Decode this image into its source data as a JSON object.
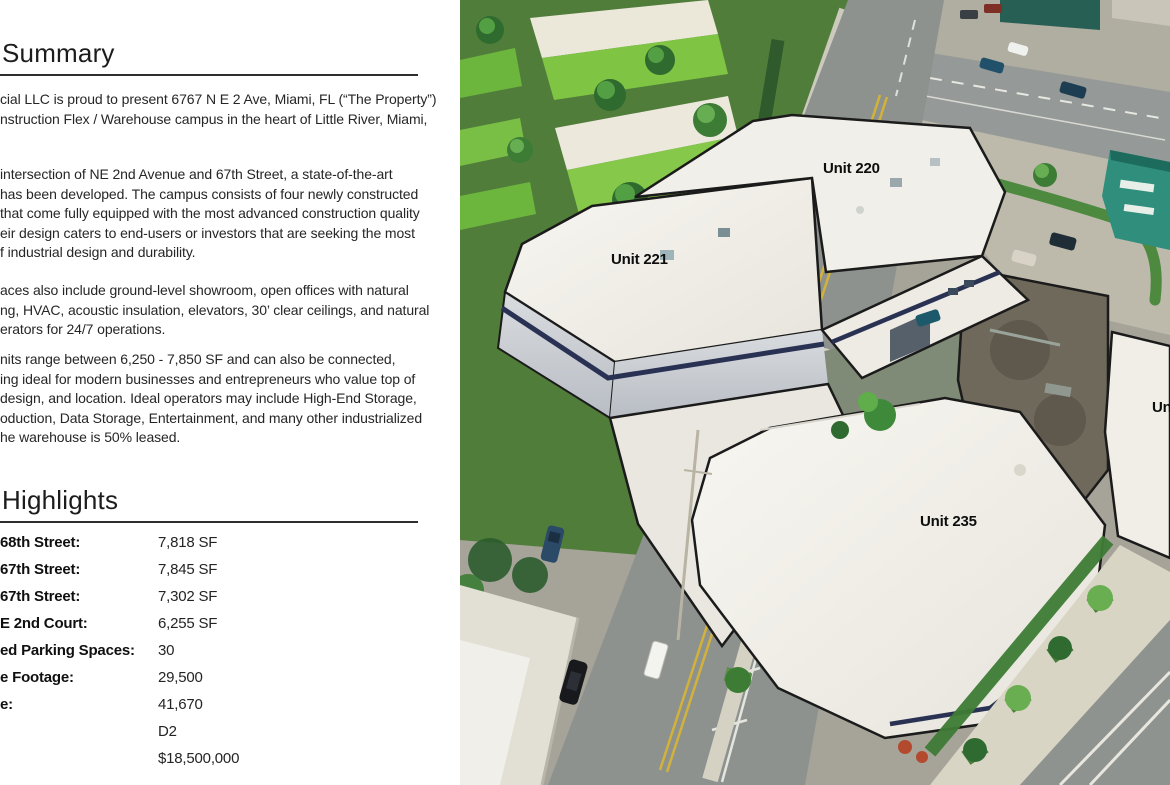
{
  "document": {
    "summary": {
      "title": "Summary",
      "paragraphs": [
        [
          "cial LLC is proud to present 6767 N E 2 Ave, Miami, FL (“The Property”)",
          "nstruction Flex / Warehouse campus in the heart of Little River, Miami,"
        ],
        [
          "intersection of NE 2nd Avenue and 67th Street, a state-of-the-art",
          "has been developed. The campus consists of four newly constructed",
          "that come fully equipped with the most advanced construction quality",
          "eir design caters to end-users or investors that are seeking the most",
          "f industrial design and durability."
        ],
        [
          "aces also include ground-level showroom, open offices with natural",
          "ng, HVAC, acoustic insulation, elevators, 30’ clear ceilings, and natural",
          "erators for 24/7 operations."
        ],
        [
          "nits range between 6,250 - 7,850 SF and can also be connected,",
          "ing ideal for modern businesses and entrepreneurs who value top of",
          "design, and location. Ideal operators may include High-End Storage,",
          "oduction, Data Storage, Entertainment, and many other industrialized",
          "he warehouse is 50% leased."
        ]
      ]
    },
    "highlights": {
      "title": "Highlights",
      "rows": [
        {
          "label": "68th Street:",
          "value": "7,818 SF"
        },
        {
          "label": "67th Street:",
          "value": "7,845 SF"
        },
        {
          "label": "67th Street:",
          "value": "7,302 SF"
        },
        {
          "label": "E 2nd Court:",
          "value": "6,255 SF"
        },
        {
          "label": "ed Parking Spaces:",
          "value": "30"
        },
        {
          "label": "e Footage:",
          "value": "29,500"
        },
        {
          "label": "e:",
          "value": "41,670"
        },
        {
          "label": "",
          "value": "D2"
        },
        {
          "label": "",
          "value": "$18,500,000"
        }
      ]
    }
  },
  "photo": {
    "description_labels": "aerial photo unit overlays",
    "unit_labels": {
      "u220": "Unit 220",
      "u221": "Unit 221",
      "u235": "Unit 235",
      "partial": "Un"
    }
  },
  "colors": {
    "text": "#1f1f1f",
    "rule": "#2e2e2e",
    "roof_white": "#f3f1eb",
    "navy_stripe": "#2a3254",
    "lime_building": "#7fc443",
    "road_gray": "#8e938f",
    "grass_green": "#517d3b",
    "old_roof_brown": "#6f695c",
    "teal_building": "#2f8f7c",
    "yellow_line": "#d2b23a"
  }
}
